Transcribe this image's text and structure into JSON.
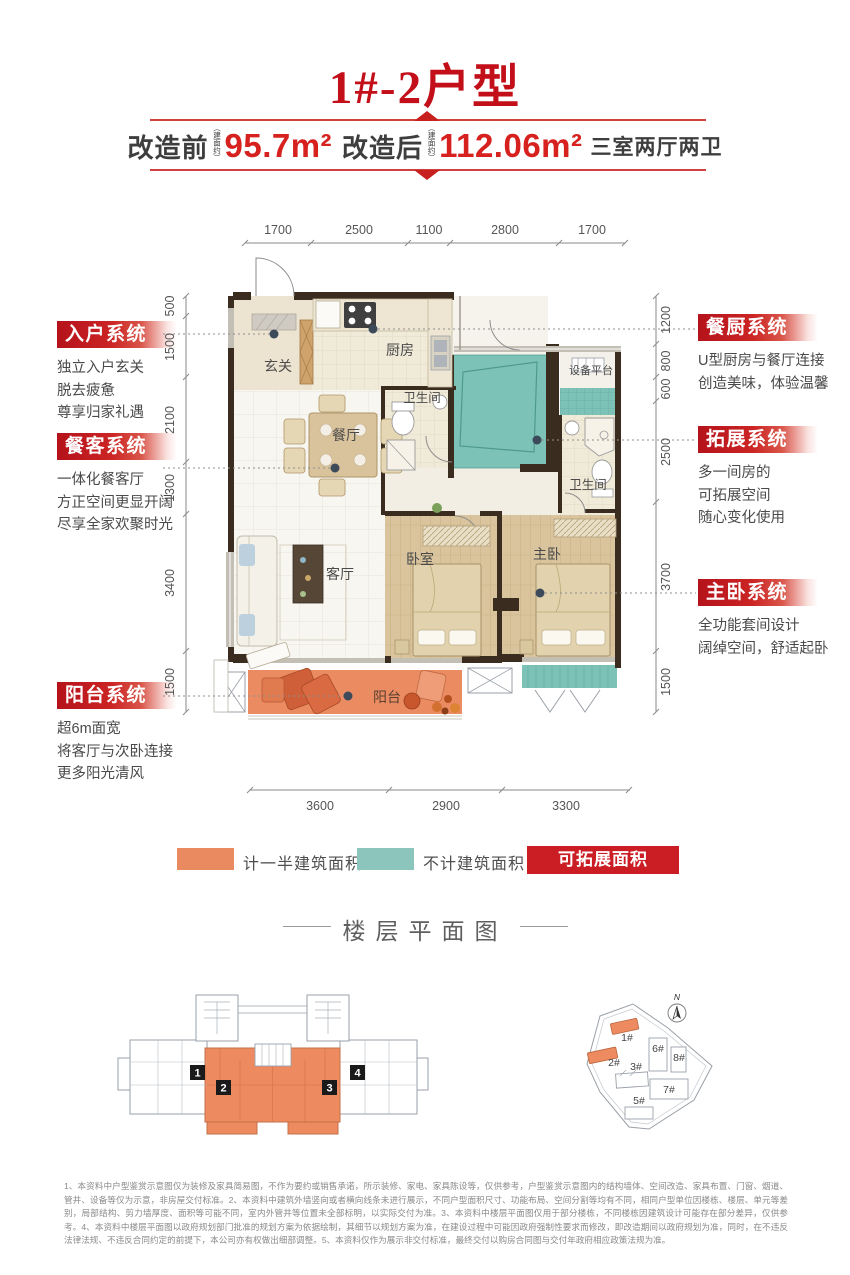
{
  "header": {
    "title": "1#-2户型",
    "banner": {
      "before_label": "改造前",
      "before_note": "（建面约）",
      "before_value": "95.7m²",
      "after_label": "改造后",
      "after_note": "（建面约）",
      "after_value": "112.06m²",
      "suffix": "三室两厅两卫"
    }
  },
  "systems_left": [
    {
      "title": "入户系统",
      "lines": [
        "独立入户玄关",
        "脱去疲惫",
        "尊享归家礼遇"
      ]
    },
    {
      "title": "餐客系统",
      "lines": [
        "一体化餐客厅",
        "方正空间更显开阔",
        "尽享全家欢聚时光"
      ]
    },
    {
      "title": "阳台系统",
      "lines": [
        "超6m面宽",
        "将客厅与次卧连接",
        "更多阳光清风"
      ]
    }
  ],
  "systems_right": [
    {
      "title": "餐厨系统",
      "lines": [
        "U型厨房与餐厅连接",
        "创造美味，体验温馨"
      ]
    },
    {
      "title": "拓展系统",
      "lines": [
        "多一间房的",
        "可拓展空间",
        "随心变化使用"
      ]
    },
    {
      "title": "主卧系统",
      "lines": [
        "全功能套间设计",
        "阔绰空间，舒适起卧"
      ]
    }
  ],
  "floorplan": {
    "rooms": {
      "entry": "玄关",
      "kitchen": "厨房",
      "bath1": "卫生间",
      "bath2": "卫生间",
      "equipment": "设备平台",
      "dining": "餐厅",
      "living": "客厅",
      "bedroom": "卧室",
      "master": "主卧",
      "balcony": "阳台"
    },
    "dims": {
      "top": [
        "1700",
        "2500",
        "1100",
        "2800",
        "1700"
      ],
      "bottom": [
        "3600",
        "2900",
        "3300"
      ],
      "left": [
        "500",
        "1500",
        "2100",
        "1300",
        "3400",
        "1500"
      ],
      "right": [
        "1200",
        "800",
        "600",
        "2500",
        "3700",
        "1500"
      ]
    }
  },
  "legend": {
    "half_area": "计一半建筑面积",
    "excluded": "不计建筑面积",
    "expandable": "可拓展面积 16.36m²"
  },
  "floor_section": {
    "title": "楼层平面图",
    "unit_numbers": [
      "1",
      "2",
      "3",
      "4"
    ],
    "site_buildings": [
      "1#",
      "2#",
      "3#",
      "5#",
      "6#",
      "7#",
      "8#"
    ],
    "compass": "N"
  },
  "disclaimer": {
    "text": "1、本资料中户型鉴赏示意图仅为装修及家具简易图，不作为要约或销售承诺，所示装修、家电、家具陈设等，仅供参考，户型鉴赏示意图内的结构墙体、空间改造、家具布置、门窗、烟道、管井、设备等仅为示意，非房屋交付标准。2、本资料中建筑外墙竖向或者横向线条未进行展示，不同户型面积尺寸、功能布局、空间分割等均有不同，相同户型单位因楼栋、楼层、单元等差别，局部结构、剪力墙厚度、面积等可能不同，室内外管井等位置未全部标明，以实际交付为准。3、本资料中楼层平面图仅用于部分楼栋，不同楼栋因建筑设计可能存在部分差异，仅供参考。4、本资料中楼层平面图以政府规划部门批准的规划方案为依据绘制，其细节以规划方案为准，在建设过程中可能因政府强制性要求而修改，即改造期间以政府规划为准，同时，在不违反法律法规、不违反合同约定的前提下，本公司亦有权做出细部调整。5、本资料仅作为展示非交付标准，最终交付以购房合同图与交付年政府相应政策法规为准。"
  },
  "colors": {
    "red": "#c4161d",
    "orange": "#ec8a62",
    "teal": "#7cc2b6"
  }
}
